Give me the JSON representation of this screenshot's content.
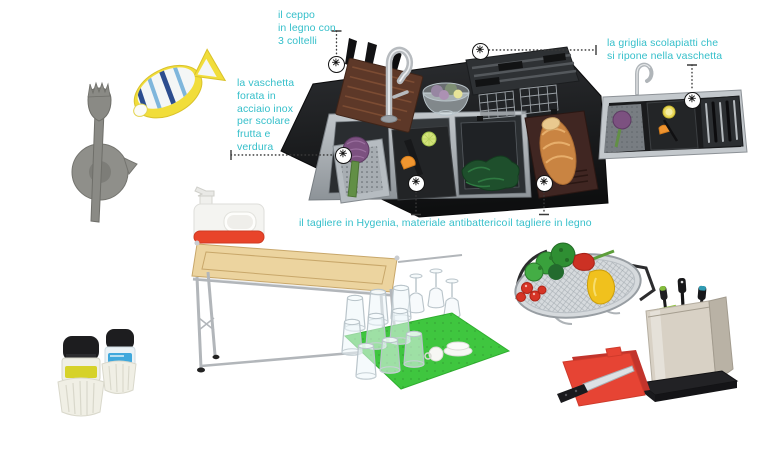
{
  "palette": {
    "accent": "#35bfca",
    "marker_ink": "#141414",
    "counter_black": "#1b1c1e",
    "steel_grey": "#9aa0a6",
    "mat_green": "#3fc63f",
    "board_red": "#e64434",
    "wood_brown": "#5d3828",
    "caddy_red": "#e8442a",
    "soap_yellow": "#d6d229",
    "soap_blue": "#3fa8dc"
  },
  "icons": {
    "asterisk": "✳"
  },
  "annotations": {
    "ceppo": "il ceppo\nin legno con\n3 coltelli",
    "vaschetta": "la vaschetta\nforata in\nacciaio inox\nper scolare\nfrutta e\nverdura",
    "griglia": "la griglia scolapiatti che\nsi ripone nella vaschetta",
    "tagliere_hygenia": "il tagliere in Hygenia, materiale antibatterico",
    "tagliere_legno": "il tagliere in legno"
  }
}
